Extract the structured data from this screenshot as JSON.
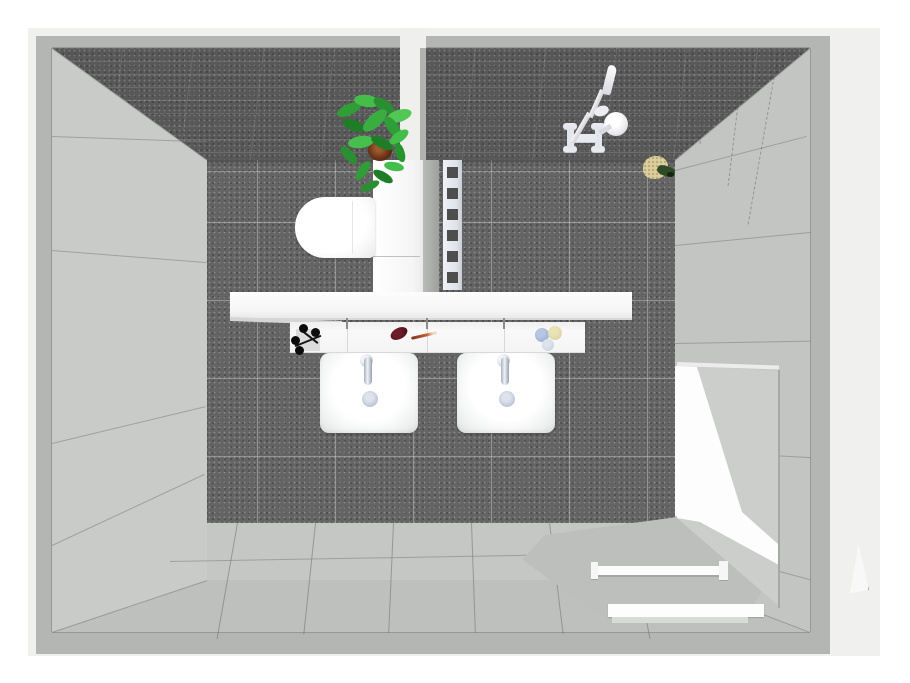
{
  "meta": {
    "kind": "3d-bathroom-floorplan-render",
    "view": "top-down-perspective",
    "visible_text": "none"
  },
  "palette": {
    "page": "#ffffff",
    "outer_panel": "#f0f0ee",
    "wall_top_band": "#b3b6b3",
    "dark_tile_wall": "#585858",
    "dark_tile_floor": "#646464",
    "light_wall_west": "#c8cbc8",
    "light_wall_east": "#c2c5c2",
    "light_wall_south": "#bdc0bd",
    "light_floor": "#c5c7c5",
    "fixture_white": "#fbfbfb",
    "plant_green": "#3aad41",
    "pot_brown": "#6b3317",
    "soap_maroon": "#5a1722",
    "soap_blue": "#8fa5cd",
    "soap_yellow": "#d8cf9d",
    "sponge_tan": "#dccf9f",
    "scrub_green": "#2e4a24"
  },
  "rooms": {
    "left_zone": "wc-area",
    "right_zone": "shower-area",
    "divider": "white partition wall"
  },
  "objects": [
    {
      "name": "toilet",
      "zone": "wc-area"
    },
    {
      "name": "potted-plant",
      "zone": "partition-top"
    },
    {
      "name": "towel-radiator",
      "zone": "shower-area"
    },
    {
      "name": "shower-mixer-and-hand-shower",
      "zone": "shower-area north wall"
    },
    {
      "name": "sponge-and-scrub",
      "zone": "shower-area floor"
    },
    {
      "name": "wall-shelf",
      "zone": "center"
    },
    {
      "name": "double-vanity-counter",
      "zone": "center"
    },
    {
      "name": "washbasin-left",
      "zone": "center"
    },
    {
      "name": "washbasin-right",
      "zone": "center"
    },
    {
      "name": "accessory-hooks",
      "zone": "counter-left"
    },
    {
      "name": "soap-maroon-oval",
      "zone": "counter-center"
    },
    {
      "name": "toothbrush",
      "zone": "counter-center"
    },
    {
      "name": "soap-set-three",
      "zone": "counter-right"
    },
    {
      "name": "open-door-panel",
      "zone": "east-wall"
    },
    {
      "name": "towel-rail-bar",
      "zone": "south-east floor"
    },
    {
      "name": "bath-mat-step",
      "zone": "south floor"
    },
    {
      "name": "door-swing-marker",
      "zone": "outside east wall"
    }
  ]
}
